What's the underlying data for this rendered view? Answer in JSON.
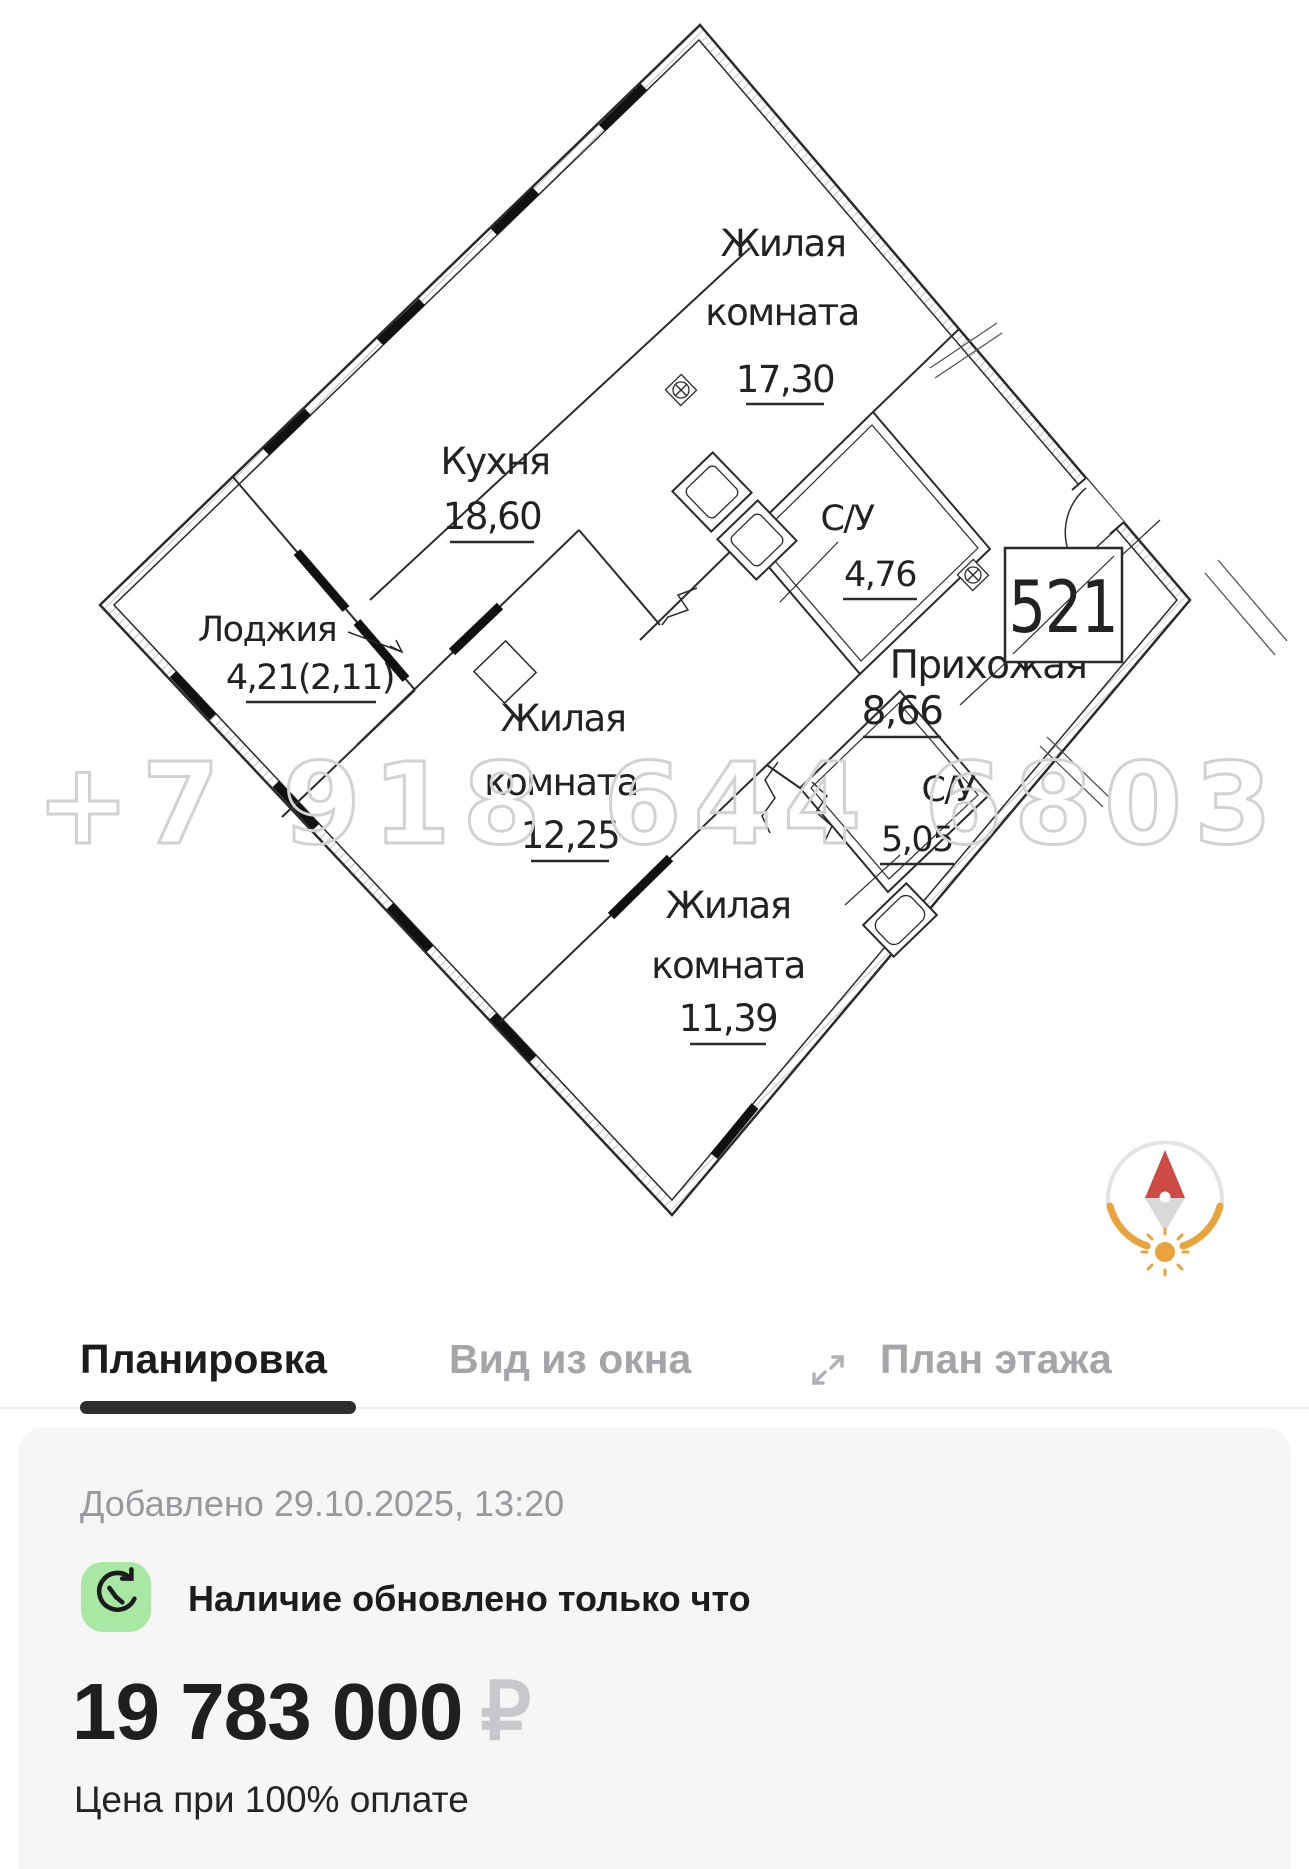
{
  "plan": {
    "rooms": [
      {
        "id": "living-1",
        "lines": [
          "Жилая",
          "комната"
        ],
        "area": "17,30"
      },
      {
        "id": "kitchen",
        "lines": [
          "Кухня"
        ],
        "area": "18,60"
      },
      {
        "id": "loggia",
        "lines": [
          "Лоджия"
        ],
        "area": "4,21(2,11)"
      },
      {
        "id": "bath-1",
        "lines": [
          "С/У"
        ],
        "area": "4,76"
      },
      {
        "id": "hallway",
        "lines": [
          "Прихожая"
        ],
        "area": "8,66"
      },
      {
        "id": "bath-2",
        "lines": [
          "С/У"
        ],
        "area": "5,05"
      },
      {
        "id": "living-2",
        "lines": [
          "Жилая",
          "комната"
        ],
        "area": "12,25"
      },
      {
        "id": "living-3",
        "lines": [
          "Жилая",
          "комната"
        ],
        "area": "11,39"
      }
    ],
    "unit_number": "521",
    "watermark": "+7 918 644 6803"
  },
  "tabs": [
    {
      "label": "Планировка",
      "active": true
    },
    {
      "label": "Вид из окна",
      "active": false
    },
    {
      "label": "План этажа",
      "active": false
    }
  ],
  "details": {
    "added": "Добавлено 29.10.2025, 13:20",
    "availability": "Наличие обновлено только что",
    "price": "19 783 000",
    "currency": "₽",
    "price_note": "Цена при 100% оплате"
  },
  "colors": {
    "accent_green": "#a9e7a4",
    "tab_active": "#1c1c1e",
    "tab_inactive": "#a4a4a9",
    "currency_gray": "#c8c8cc",
    "watermark_gray": "#d2d2d4",
    "compass_orange": "#e8a33d",
    "compass_red": "#cc4b44",
    "plan_line": "#2b2b2b"
  }
}
